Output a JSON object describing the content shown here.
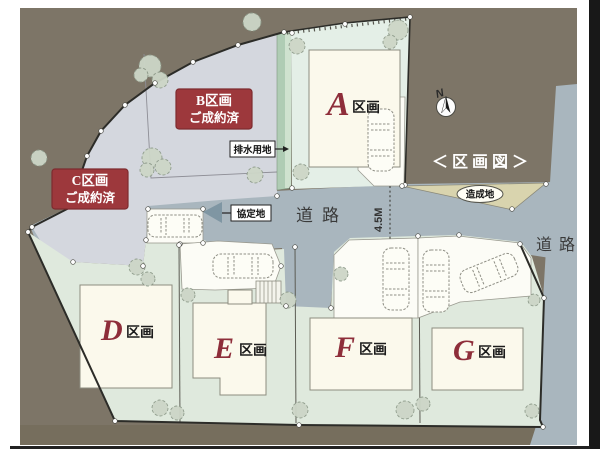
{
  "title": "＜区画図＞",
  "compass": {
    "north_label": "N"
  },
  "plots": {
    "a": {
      "letter": "A",
      "suffix": "区画"
    },
    "b": {
      "name": "B区画",
      "status": "ご成約済"
    },
    "c": {
      "name": "C区画",
      "status": "ご成約済"
    },
    "d": {
      "letter": "D",
      "suffix": "区画"
    },
    "e": {
      "letter": "E",
      "suffix": "区画"
    },
    "f": {
      "letter": "F",
      "suffix": "区画"
    },
    "g": {
      "letter": "G",
      "suffix": "区画"
    }
  },
  "labels": {
    "drainage": "排水用地",
    "agreement": "協定地",
    "graded_land": "造成地",
    "road_center": "道路",
    "road_right": "道路",
    "road_width": "4.5M"
  },
  "colors": {
    "background_ground": "#7d7567",
    "road": "#a9b6be",
    "sold_area": "#d4d7de",
    "plot_green": "#dfe9dd",
    "plot_a_green": "#e4efe7",
    "house_cream": "#fbf9ec",
    "drainage_green": "#afccb4",
    "graded_tan": "#d9d4ae",
    "sold_box_red": "#9d383c",
    "plot_letter_red": "#8e2e3a"
  }
}
